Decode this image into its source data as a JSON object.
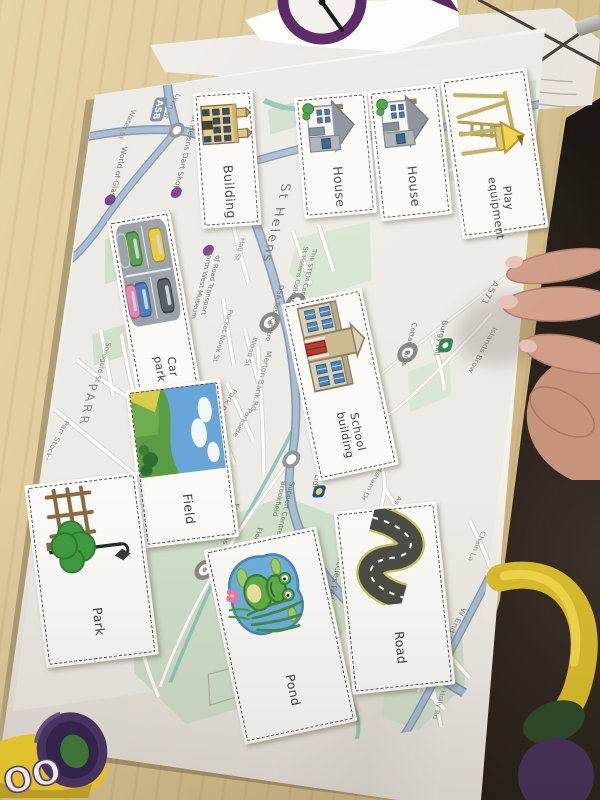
{
  "scene": "worksheet map activity photo",
  "cards": [
    {
      "label": "Building",
      "illustration": "building"
    },
    {
      "label": "House",
      "illustration": "house"
    },
    {
      "label": "House",
      "illustration": "house"
    },
    {
      "label": "Play equipment",
      "illustration": "play-equipment"
    },
    {
      "label": "Car park",
      "illustration": "car-park"
    },
    {
      "label": "School building",
      "illustration": "school-building"
    },
    {
      "label": "Field",
      "illustration": "field"
    },
    {
      "label": "Park",
      "illustration": "park"
    },
    {
      "label": "Pond",
      "illustration": "pond"
    },
    {
      "label": "Road",
      "illustration": "road"
    }
  ],
  "map": {
    "labels": [
      {
        "text": "St Helens"
      },
      {
        "text": "St Helens Central"
      },
      {
        "text": "Water St"
      },
      {
        "text": "Lyon St"
      },
      {
        "text": "World of Glass"
      },
      {
        "text": "St Helens Dart Shop"
      },
      {
        "text": "A58"
      },
      {
        "text": "North West Museum"
      },
      {
        "text": "of Road Transport"
      },
      {
        "text": "Hall St"
      },
      {
        "text": "Pocket Nook St"
      },
      {
        "text": "Wood St"
      },
      {
        "text": "Merton Bank Rd"
      },
      {
        "text": "Park Rd"
      },
      {
        "text": "Parkside"
      },
      {
        "text": "Union St"
      },
      {
        "text": "Sorogold St"
      },
      {
        "text": "PARR"
      },
      {
        "text": "Parr Stocks Rd"
      },
      {
        "text": "St Helens College -"
      },
      {
        "text": "The STEM Centre..."
      },
      {
        "text": "DSA Test Centre"
      },
      {
        "text": "FC ST HELENS"
      },
      {
        "text": "Cottam Bros"
      },
      {
        "text": "Burgy hill"
      },
      {
        "text": "A571"
      },
      {
        "text": "Islands Brow"
      },
      {
        "text": "Lidl"
      },
      {
        "text": "Brookfield"
      },
      {
        "text": "Support Centre"
      },
      {
        "text": "Frodsham Dr"
      },
      {
        "text": "Fred Davies (Storage)"
      },
      {
        "text": "Florist Supp"
      },
      {
        "text": "Maccies Field"
      },
      {
        "text": "BROAD OAK"
      },
      {
        "text": "Ashurst"
      },
      {
        "text": "Chain La"
      },
      {
        "text": "W End Rd"
      },
      {
        "text": "Folds Rd"
      },
      {
        "text": "Holly Rd"
      }
    ]
  },
  "objects": {
    "playdoh_visible_letters": "OO"
  },
  "colors": {
    "major_road": "#9fb2c8",
    "map_green": "#cfe0cb",
    "poi_purple": "#7b3f8f",
    "spinner_ring": "#5c2a66",
    "playdoh_yellow": "#f0d12e",
    "playdoh_lid": "#4a3566"
  }
}
